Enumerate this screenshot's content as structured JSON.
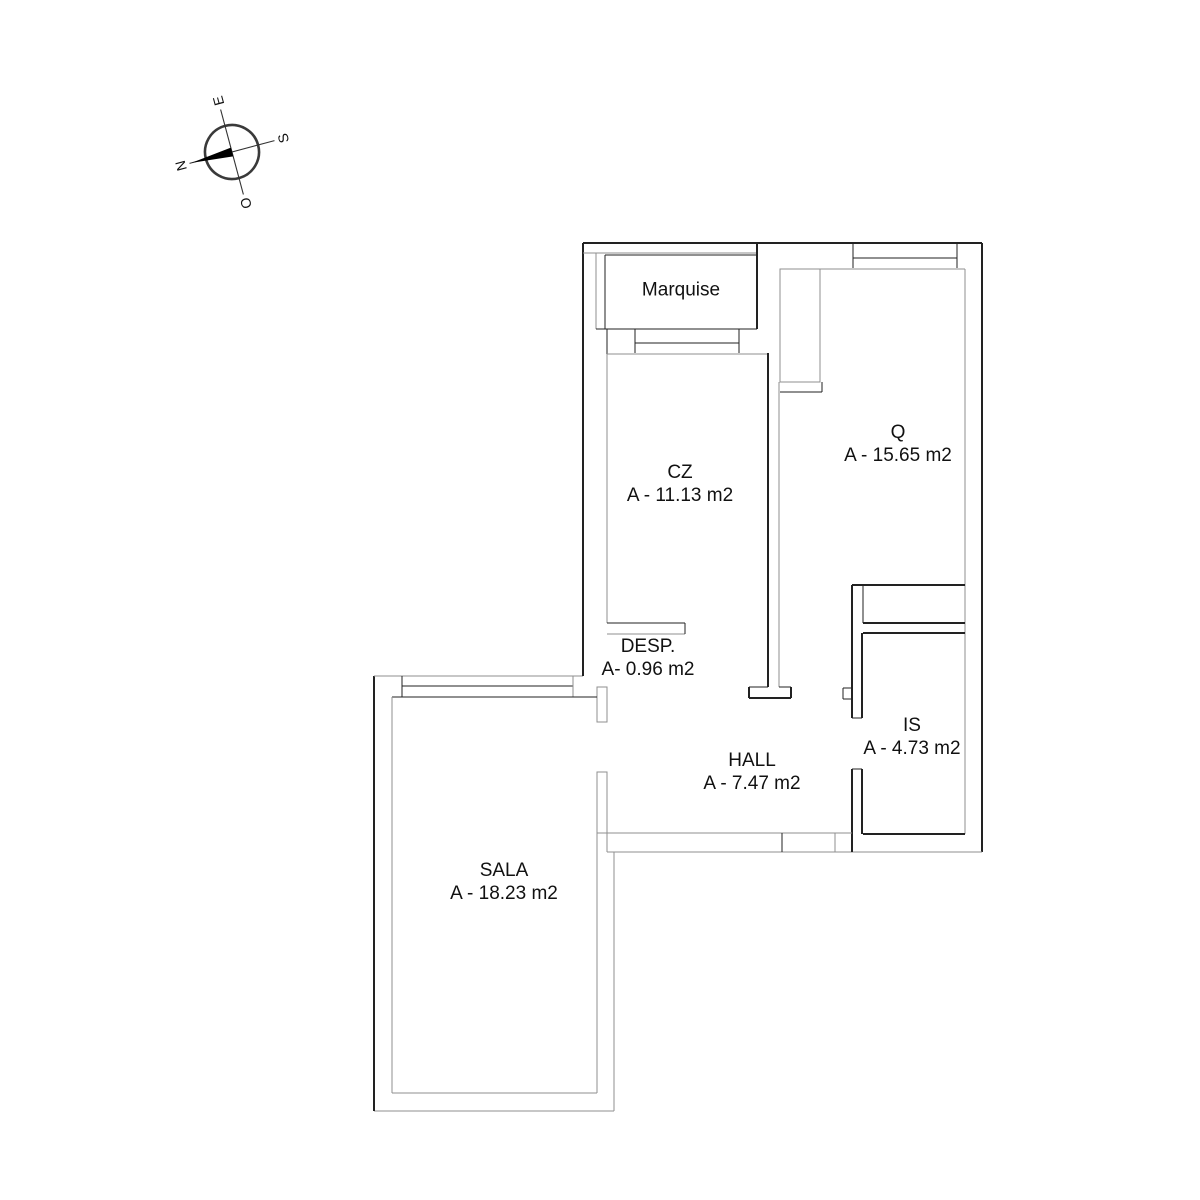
{
  "compass": {
    "n": "N",
    "s": "S",
    "e": "E",
    "o": "O"
  },
  "rooms": {
    "marquise": {
      "name": "Marquise",
      "area": ""
    },
    "cz": {
      "name": "CZ",
      "area": "A - 11.13 m2"
    },
    "q": {
      "name": "Q",
      "area": "A - 15.65 m2"
    },
    "desp": {
      "name": "DESP.",
      "area": "A- 0.96 m2"
    },
    "is": {
      "name": "IS",
      "area": "A - 4.73 m2"
    },
    "hall": {
      "name": "HALL",
      "area": "A - 7.47 m2"
    },
    "sala": {
      "name": "SALA",
      "area": "A - 18.23 m2"
    }
  },
  "colors": {
    "wall_dark": "#222222",
    "wall_light": "#8f8f8f",
    "text": "#111111",
    "needle": "#000000"
  }
}
